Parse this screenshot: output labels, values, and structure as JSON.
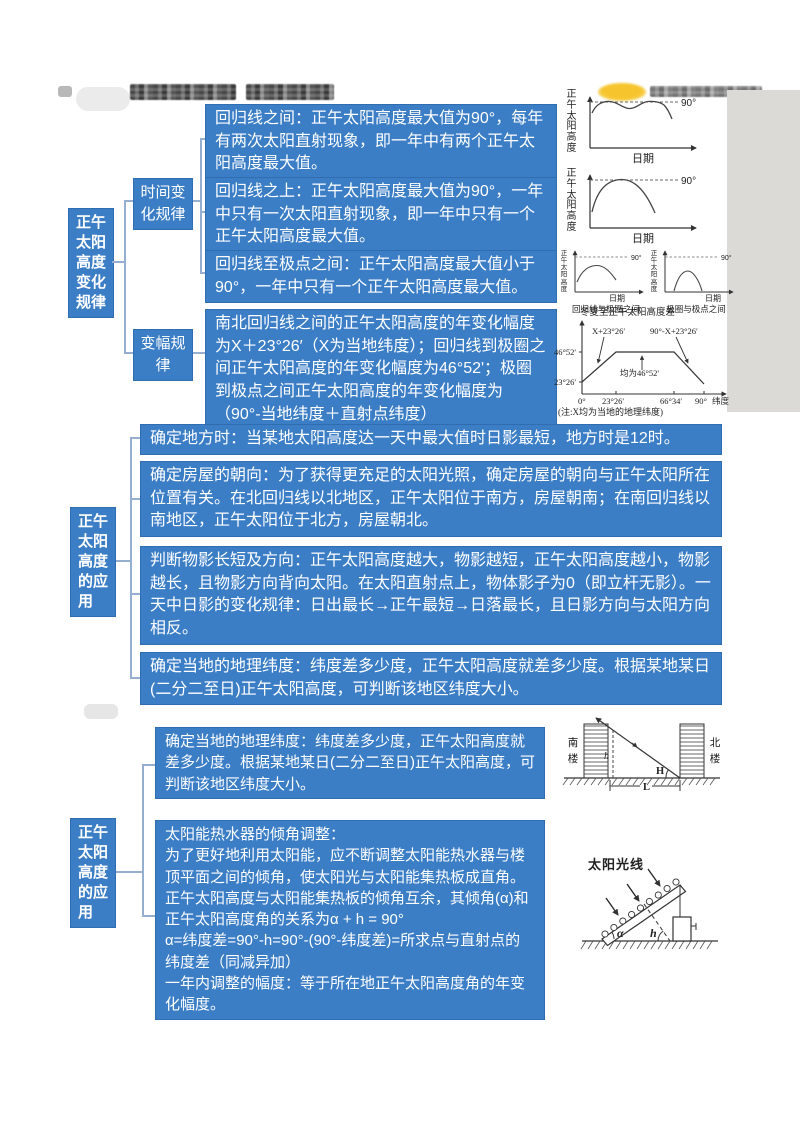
{
  "s1": {
    "root": "正午太阳高度变化规律",
    "branch1": "时间变化规律",
    "branch2": "变幅规律",
    "leaf1": "回归线之间：正午太阳高度最大值为90°，每年有两次太阳直射现象，即一年中有两个正午太阳高度最大值。",
    "leaf2": "回归线之上：正午太阳高度最大值为90°，一年中只有一次太阳直射现象，即一年中只有一个正午太阳高度最大值。",
    "leaf3": "回归线至极点之间：正午太阳高度最大值小于90°，一年中只有一个正午太阳高度最大值。",
    "leaf4": "南北回归线之间的正午太阳高度的年变化幅度为X＋23°26′（X为当地纬度）；回归线到极圈之间正午太阳高度的年变化幅度为46°52'；极圈到极点之间正午太阳高度的年变化幅度为（90°-当地纬度＋直射点纬度）"
  },
  "s2": {
    "root": "正午太阳高度的应用",
    "box1": "确定地方时：当某地太阳高度达一天中最大值时日影最短，地方时是12时。",
    "box2": "确定房屋的朝向：为了获得更充足的太阳光照，确定房屋的朝向与正午太阳所在位置有关。在北回归线以北地区，正午太阳位于南方，房屋朝南；在南回归线以南地区，正午太阳位于北方，房屋朝北。",
    "box3": "判断物影长短及方向：正午太阳高度越大，物影越短，正午太阳高度越小，物影越长，且物影方向背向太阳。在太阳直射点上，物体影子为0（即立杆无影）。一天中日影的变化规律：日出最长→正午最短→日落最长，且日影方向与太阳方向相反。",
    "box4": "确定当地的地理纬度：纬度差多少度，正午太阳高度就差多少度。根据某地某日(二分二至日)正午太阳高度，可判断该地区纬度大小。"
  },
  "s3": {
    "root": "正午太阳高度的应用",
    "box1": "确定当地的地理纬度：纬度差多少度，正午太阳高度就差多少度。根据某地某日(二分二至日)正午太阳高度，可判断该地区纬度大小。",
    "solar_title": "太阳能热水器的倾角调整：",
    "solar_p1": "为了更好地利用太阳能，应不断调整太阳能热水器与楼顶平面之间的倾角，使太阳光与太阳能集热板成直角。正午太阳高度与太阳能集热板的倾角互余，其倾角(α)和正午太阳高度角的关系为α + h = 90°",
    "solar_p2": "α=纬度差=90°-h=90°-(90°-纬度差)=所求点与直射点的纬度差（同减异加）",
    "solar_p3": "一年内调整的幅度：等于所在地正午太阳高度角的年变化幅度。"
  },
  "charts": {
    "ylabel": "正午太阳高度",
    "xlabel": "日期",
    "ref90": "90°",
    "cap_c": "回归线与极圈之间",
    "cap_d": "极圈与极点之间"
  },
  "amp_diagram": {
    "title": "冬夏至正午太阳高度差",
    "ytick1": "46°52′",
    "ytick2": "23°26′",
    "xtick0": "0°",
    "xtick1": "23°26′",
    "xtick2": "66°34′",
    "xtick3": "90°",
    "xunit": "纬度",
    "ann_rise": "X+23°26′",
    "ann_flat": "均为46°52′",
    "ann_fall": "90°-X+23°26′",
    "note": "(注:X均为当地的地理纬度)"
  },
  "building_diagram": {
    "south": "南楼",
    "north": "北楼",
    "h": "h",
    "H": "H",
    "L": "L"
  },
  "panel_diagram": {
    "title": "太阳光线",
    "alpha": "α",
    "h": "h"
  },
  "colors": {
    "box_blue": "#3b7ec6",
    "connector": "#96aecf",
    "watermark_yellow": "#f6c52e",
    "gray_strip": "#dcdad7"
  },
  "chart_data": [
    {
      "type": "line",
      "xlabel": "日期",
      "ylabel": "正午太阳高度",
      "ref_line": "90°",
      "shape": "双峰曲线，一年两次触及90°"
    },
    {
      "type": "line",
      "xlabel": "日期",
      "ylabel": "正午太阳高度",
      "ref_line": "90°",
      "shape": "单峰曲线，一年一次触及90°"
    },
    {
      "type": "line",
      "caption": "回归线与极圈之间",
      "xlabel": "日期",
      "ylabel": "正午太阳高度",
      "ref_line": "90°",
      "shape": "单峰曲线，最大值小于90°"
    },
    {
      "type": "line",
      "caption": "极圈与极点之间",
      "xlabel": "日期",
      "ylabel": "正午太阳高度",
      "ref_line": "90°",
      "shape": "矮单峰曲线，从0升起又降回0，最大值远小于90°"
    },
    {
      "type": "line",
      "title": "冬夏至正午太阳高度差",
      "xlabel": "纬度",
      "x_ticks": [
        "0°",
        "23°26′",
        "66°34′",
        "90°"
      ],
      "y_ticks": [
        "23°26′",
        "46°52′"
      ],
      "shape": "梯形：0°处为23°26′，升至23°26′—66°34′间恒为46°52′，再向90°递减",
      "annotations": [
        "X+23°26′",
        "均为46°52′",
        "90°-X+23°26′"
      ],
      "note": "(注:X均为当地的地理纬度)"
    }
  ]
}
